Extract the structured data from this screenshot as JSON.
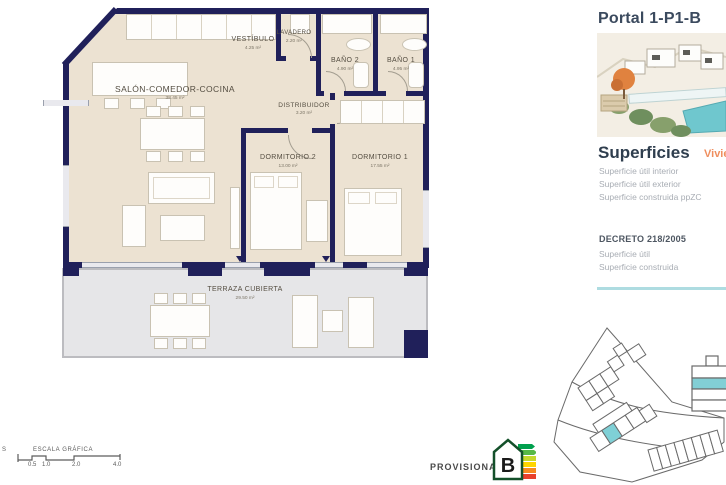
{
  "document": {
    "type": "apartment floor plan sheet"
  },
  "sidebar": {
    "title": "Portal 1-P1-B",
    "superficies": {
      "heading": "Superficies",
      "tag": "Vivie",
      "rows": [
        "Superficie útil interior",
        "Superficie útil exterior",
        "Superficie construida ppZC"
      ]
    },
    "decreto": {
      "heading": "DECRETO 218/2005",
      "rows": [
        "Superficie útil",
        "Superficie construida"
      ]
    }
  },
  "plan": {
    "rooms": [
      {
        "name": "SALÓN-COMEDOR-COCINA",
        "area": "38.45 m²"
      },
      {
        "name": "VESTÍBULO",
        "area": "4.25 m²"
      },
      {
        "name": "LAVADERO",
        "area": "2.20 m²"
      },
      {
        "name": "BAÑO 2",
        "area": "4.90 m²"
      },
      {
        "name": "BAÑO 1",
        "area": "4.95 m²"
      },
      {
        "name": "DISTRIBUIDOR",
        "area": "3.20 m²"
      },
      {
        "name": "DORMITORIO 2",
        "area": "13.00 m²"
      },
      {
        "name": "DORMITORIO 1",
        "area": "17.55 m²"
      },
      {
        "name": "TERRAZA CUBIERTA",
        "area": "29.50 m²"
      }
    ]
  },
  "footer": {
    "scale": {
      "prefix": "S",
      "label": "ESCALA GRÁFICA",
      "ticks": [
        "0.5",
        "1.0",
        "2.0",
        "4.0"
      ]
    },
    "provisional": "PROVISIONAL",
    "energy_rating": "B"
  },
  "colors": {
    "wall_navy": "#20205a",
    "floor_beige": "#ece2d2",
    "terrace_gray": "#e6e6e8",
    "accent_teal": "#7fd0d6",
    "divider_teal": "#aedce1",
    "accent_orange": "#ef8e5e",
    "heading_slate": "#3b4a5e",
    "muted_gray": "#a8adb4"
  }
}
